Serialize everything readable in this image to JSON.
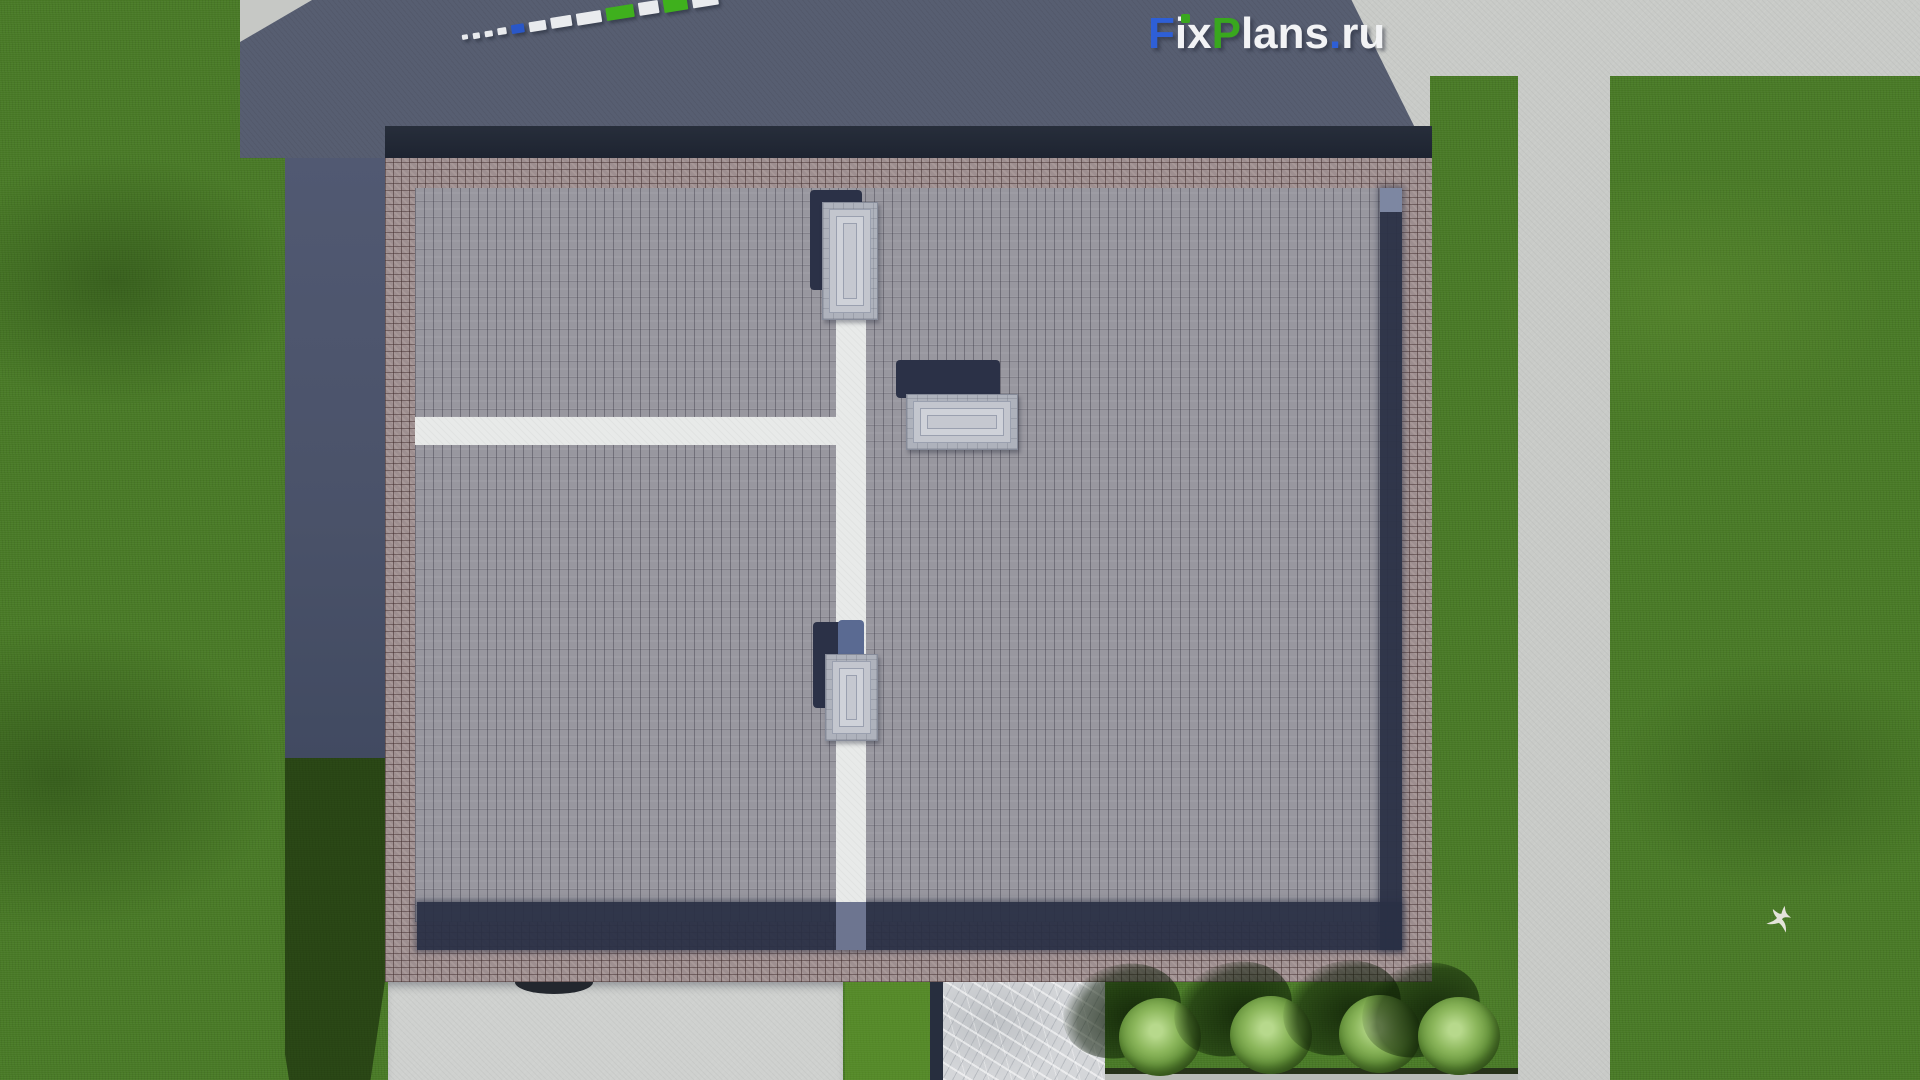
{
  "watermark": {
    "text": "FixPlans.ru",
    "parts": [
      {
        "t": "F",
        "c": "#2e5fd6"
      },
      {
        "t": "ix",
        "c": "#f2f3f5"
      },
      {
        "t": "P",
        "c": "#39a71e"
      },
      {
        "t": "lans",
        "c": "#f2f3f5"
      },
      {
        "t": ".",
        "c": "#2e5fd6"
      },
      {
        "t": "ru",
        "c": "#f2f3f5"
      }
    ],
    "i_dot_color": "#39a71e"
  },
  "ruler": {
    "segments": [
      {
        "c": "#e9ebee",
        "w": 6,
        "h": 5
      },
      {
        "c": "#e9ebee",
        "w": 7,
        "h": 6
      },
      {
        "c": "#e9ebee",
        "w": 8,
        "h": 6
      },
      {
        "c": "#e9ebee",
        "w": 9,
        "h": 7
      },
      {
        "c": "#2a57c7",
        "w": 13,
        "h": 9
      },
      {
        "c": "#e9ebee",
        "w": 17,
        "h": 10
      },
      {
        "c": "#e9ebee",
        "w": 21,
        "h": 11
      },
      {
        "c": "#e9ebee",
        "w": 25,
        "h": 12
      },
      {
        "c": "#3fb01d",
        "w": 28,
        "h": 13
      },
      {
        "c": "#e9ebee",
        "w": 20,
        "h": 13
      },
      {
        "c": "#3fb01d",
        "w": 24,
        "h": 14
      },
      {
        "c": "#e9ebee",
        "w": 26,
        "h": 15
      }
    ]
  },
  "scene": {
    "type": "aerial-3d-render-roof-plan",
    "skylight_count": 3,
    "bush_count": 4,
    "bird_present": true
  },
  "palette": {
    "grass": "#497a26",
    "grass_shadow": "#263f14",
    "concrete_lit": "#c9cbc8",
    "concrete_shadow": "#575e71",
    "roof_tile": "#98979f",
    "brick_border": "#9e8f90",
    "parapet_shadow": "#293045",
    "roof_path_white": "#e8eae9",
    "marble": "#d4d6d9",
    "skylight": "#c3c6ce"
  }
}
